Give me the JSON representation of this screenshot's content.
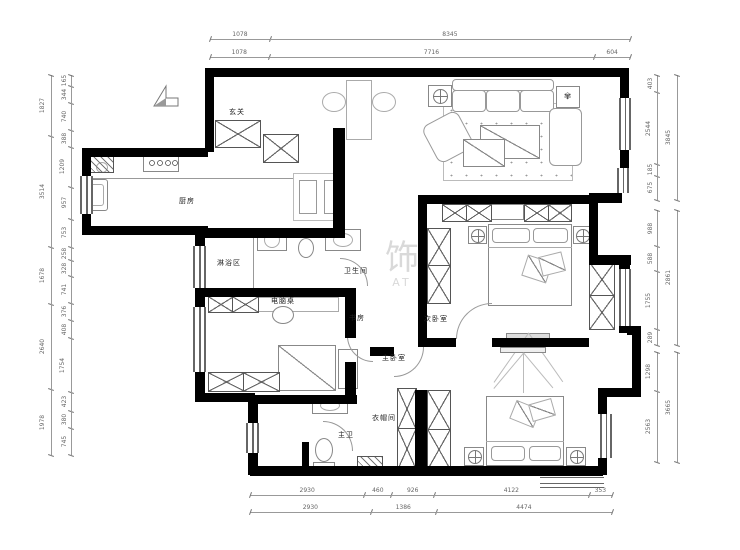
{
  "meta": {
    "title": "apartment floor plan"
  },
  "rooms": {
    "entry": "玄关",
    "kitchen": "厨房",
    "shower": "淋浴区",
    "bathroom": "卫生间",
    "desk": "电脑桌",
    "study": "书房",
    "bedroom2": "次卧室",
    "master": "主卧室",
    "cloakroom": "衣帽间",
    "master_bath": "主卫"
  },
  "watermark": {
    "glyph": "饰",
    "text": "AT"
  },
  "dims": {
    "top": [
      [
        "1078",
        "8345"
      ],
      [
        "1078",
        "7716",
        "604"
      ]
    ],
    "bottom": [
      [
        "2930",
        "460",
        "926",
        "4122",
        "353"
      ],
      [
        "2930",
        "1386",
        "4474"
      ]
    ],
    "left": {
      "outer": [
        "1827",
        "3514",
        "1678",
        "2640",
        "1978"
      ],
      "inner": [
        "165",
        "344",
        "740",
        "388",
        "1209",
        "957",
        "753",
        "258",
        "328",
        "741",
        "376",
        "408",
        "1754",
        "423",
        "380",
        "745"
      ]
    },
    "right": {
      "inner1": [
        "403",
        "2544",
        "185",
        "675"
      ],
      "inner2": [
        "988",
        "588",
        "1755",
        "289"
      ],
      "inner3": [
        "1298",
        "2563"
      ],
      "outer1": [
        "3845"
      ],
      "outer2": [
        "2861"
      ],
      "outer3": [
        "3665"
      ]
    }
  },
  "icons": {
    "north": "north-arrow"
  }
}
